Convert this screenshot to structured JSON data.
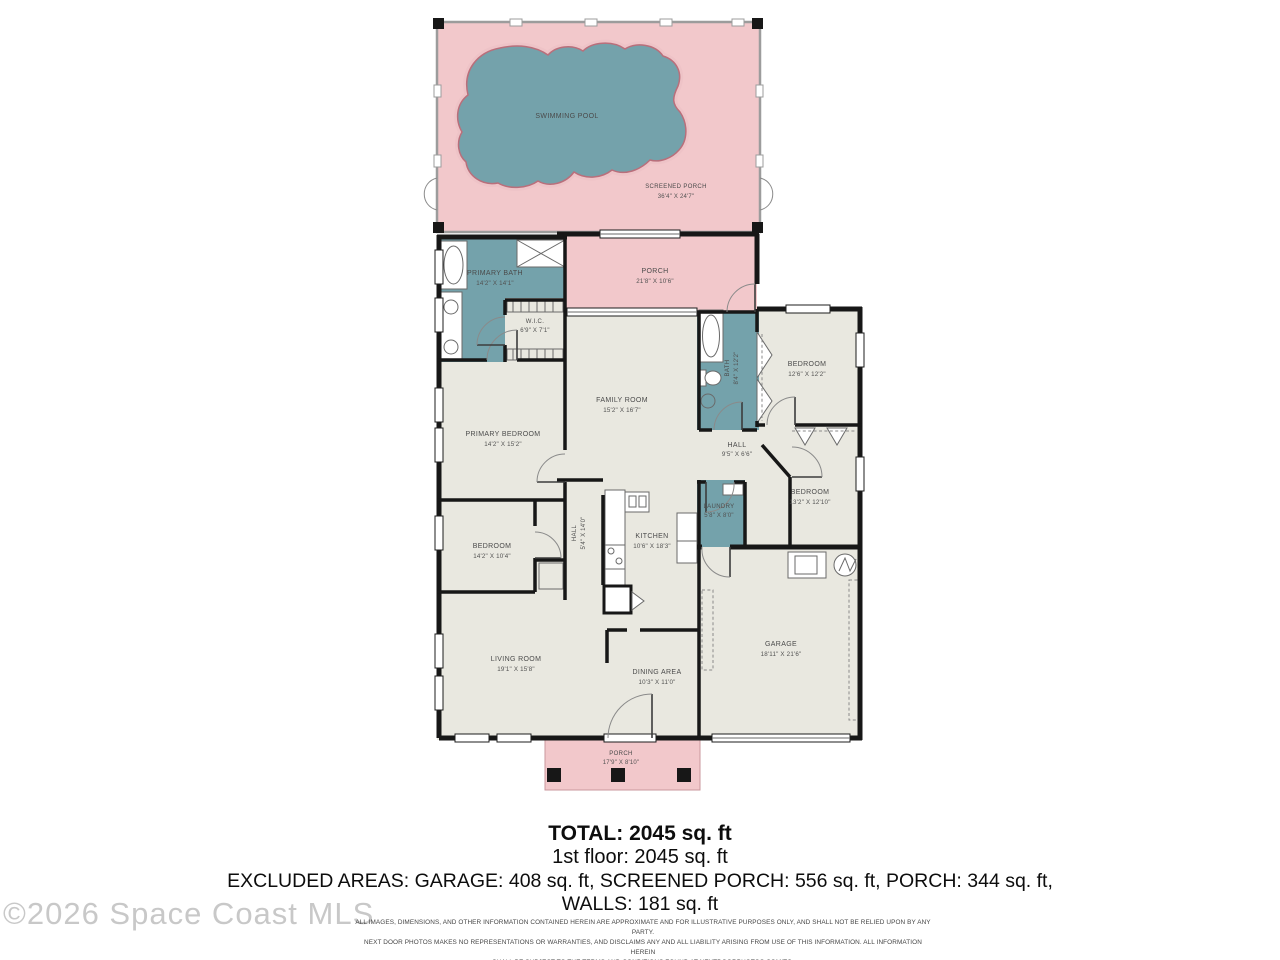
{
  "plan": {
    "rooms": {
      "swimming_pool": {
        "name": "SWIMMING POOL",
        "dims": ""
      },
      "screened_porch": {
        "name": "SCREENED PORCH",
        "dims": "36'4\" X 24'7\""
      },
      "porch_rear": {
        "name": "PORCH",
        "dims": "21'8\" X 10'6\""
      },
      "primary_bath": {
        "name": "PRIMARY BATH",
        "dims": "14'2\" X 14'1\""
      },
      "wic": {
        "name": "W.I.C.",
        "dims": "6'9\" X 7'1\""
      },
      "family_room": {
        "name": "FAMILY ROOM",
        "dims": "15'2\" X 16'7\""
      },
      "bath": {
        "name": "BATH",
        "dims": "8'4\" X 12'2\""
      },
      "bedroom_ne": {
        "name": "BEDROOM",
        "dims": "12'6\" X 12'2\""
      },
      "hall_east": {
        "name": "HALL",
        "dims": "9'5\" X 6'6\""
      },
      "bedroom_se": {
        "name": "BEDROOM",
        "dims": "13'2\" X 12'10\""
      },
      "laundry": {
        "name": "LAUNDRY",
        "dims": "5'8\" X 8'0\""
      },
      "primary_bedroom": {
        "name": "PRIMARY BEDROOM",
        "dims": "14'2\" X 15'2\""
      },
      "bedroom_w": {
        "name": "BEDROOM",
        "dims": "14'2\" X 10'4\""
      },
      "hall_center": {
        "name": "HALL",
        "dims": "5'4\" X 14'0\""
      },
      "kitchen": {
        "name": "KITCHEN",
        "dims": "10'6\" X 18'3\""
      },
      "living_room": {
        "name": "LIVING ROOM",
        "dims": "19'1\" X 15'8\""
      },
      "dining_area": {
        "name": "DINING AREA",
        "dims": "10'3\" X 11'0\""
      },
      "garage": {
        "name": "GARAGE",
        "dims": "18'11\" X 21'6\""
      },
      "porch_front": {
        "name": "PORCH",
        "dims": "17'9\" X 8'10\""
      }
    }
  },
  "summary": {
    "total": "TOTAL: 2045 sq. ft",
    "first_floor": "1st floor: 2045 sq. ft",
    "excluded": "EXCLUDED AREAS: GARAGE: 408 sq. ft, SCREENED PORCH: 556 sq. ft, PORCH: 344 sq. ft,",
    "walls": "WALLS: 181 sq. ft"
  },
  "watermark": "©2026 Space Coast MLS",
  "disclaimer": {
    "line1": "ALL IMAGES, DIMENSIONS, AND OTHER INFORMATION CONTAINED HEREIN ARE APPROXIMATE AND FOR ILLUSTRATIVE PURPOSES ONLY, AND SHALL NOT BE RELIED UPON BY ANY PARTY.",
    "line2": "NEXT DOOR PHOTOS MAKES NO REPRESENTATIONS OR WARRANTIES, AND DISCLAIMS ANY AND ALL LIABILITY ARISING FROM USE OF THIS INFORMATION. ALL INFORMATION HEREIN",
    "line3": "SHALL BE SUBJECT TO THE TERMS AND CONDITIONS FOUND AT NEXTDOORPHOTOS.COM/TC."
  },
  "colors": {
    "porch_pink": "#f2c8cb",
    "water_teal": "#74a2ab",
    "room_beige": "#e9e8e0",
    "wall_black": "#171717"
  }
}
